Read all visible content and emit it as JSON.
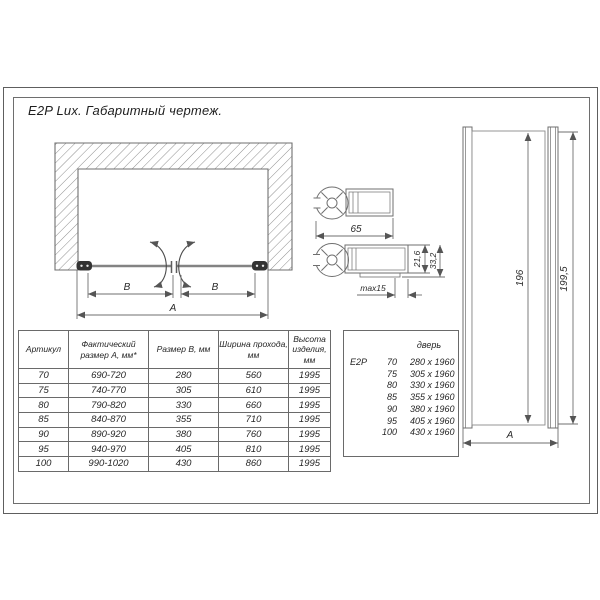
{
  "title": "E2P Lux. Габаритный чертеж.",
  "niche_drawing": {
    "dim_b_left": "B",
    "dim_b_right": "B",
    "dim_a": "A"
  },
  "hinge_profile_top": {
    "width": "65"
  },
  "hinge_profile_bottom": {
    "adjust": "max15",
    "depth_min": "21,6",
    "depth_max": "33,2"
  },
  "door_view": {
    "glass_height": "196",
    "total_height": "199,5",
    "width_label": "A"
  },
  "size_table": {
    "headers": [
      "Артикул",
      "Фактический размер А, мм*",
      "Размер В, мм",
      "Ширина прохода, мм",
      "Высота изделия, мм"
    ],
    "rows": [
      [
        "70",
        "690-720",
        "280",
        "560",
        "1995"
      ],
      [
        "75",
        "740-770",
        "305",
        "610",
        "1995"
      ],
      [
        "80",
        "790-820",
        "330",
        "660",
        "1995"
      ],
      [
        "85",
        "840-870",
        "355",
        "710",
        "1995"
      ],
      [
        "90",
        "890-920",
        "380",
        "760",
        "1995"
      ],
      [
        "95",
        "940-970",
        "405",
        "810",
        "1995"
      ],
      [
        "100",
        "990-1020",
        "430",
        "860",
        "1995"
      ]
    ]
  },
  "door_table": {
    "header": "дверь",
    "series": "E2P",
    "rows": [
      [
        "70",
        "280 x 1960"
      ],
      [
        "75",
        "305 x 1960"
      ],
      [
        "80",
        "330 x 1960"
      ],
      [
        "85",
        "355 x 1960"
      ],
      [
        "90",
        "380 x 1960"
      ],
      [
        "95",
        "405 x 1960"
      ],
      [
        "100",
        "430 x 1960"
      ]
    ]
  },
  "colors": {
    "line": "#6f6f6f",
    "text": "#262626",
    "hinge": "#333333"
  }
}
